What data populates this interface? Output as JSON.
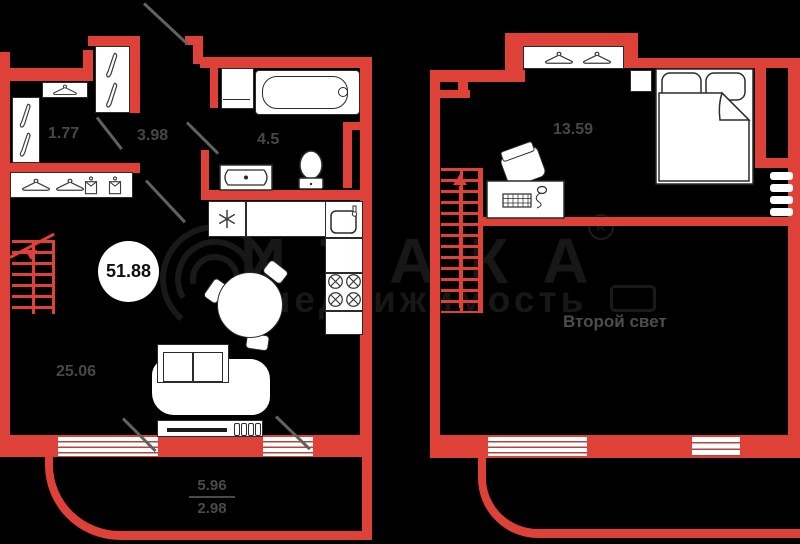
{
  "colors": {
    "wall_red": "#de4138",
    "background": "#000000",
    "furniture_line": "#2b2b2b",
    "label_gray": "#474747",
    "door_gray": "#616161",
    "watermark_gray": "#171717"
  },
  "floor1": {
    "room_areas": {
      "closet": "1.77",
      "hall": "3.98",
      "bath": "4.5",
      "living": "25.06"
    },
    "total_area": "51.88",
    "balcony_area_full": "5.96",
    "balcony_area_half": "2.98"
  },
  "floor2": {
    "bedroom_area": "13.59",
    "void_label": "Второй свет"
  },
  "watermark": {
    "brand": "ИТАКА",
    "registered": "R",
    "word": "недвижимость",
    "year": "1993"
  }
}
